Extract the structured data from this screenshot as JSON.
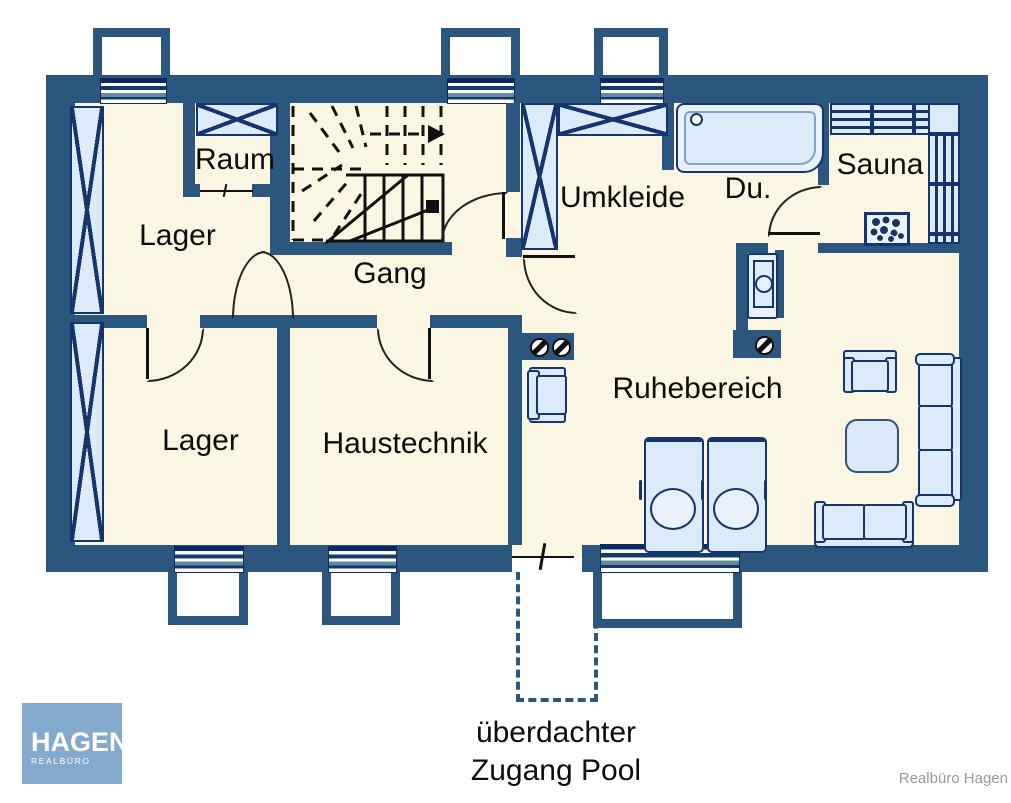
{
  "plan": {
    "rooms": {
      "raum": "Raum",
      "lager_top": "Lager",
      "gang": "Gang",
      "umkleide": "Umkleide",
      "dusche": "Du.",
      "sauna": "Sauna",
      "lager_bottom": "Lager",
      "haustechnik": "Haustechnik",
      "ruhebereich": "Ruhebereich"
    },
    "caption": {
      "line1": "überdachter",
      "line2": "Zugang Pool"
    },
    "branding": {
      "logo_title": "HAGEN",
      "logo_subtitle": "REALBÜRO",
      "watermark": "Realbüro Hagen"
    },
    "colors": {
      "wall": "#2b567e",
      "floor": "#fbf6e2",
      "furniture_fill": "#dcebf9",
      "furniture_outline": "#16356e",
      "window_navy": "#0c2a5e",
      "logo_blue": "#83a9cd"
    }
  }
}
